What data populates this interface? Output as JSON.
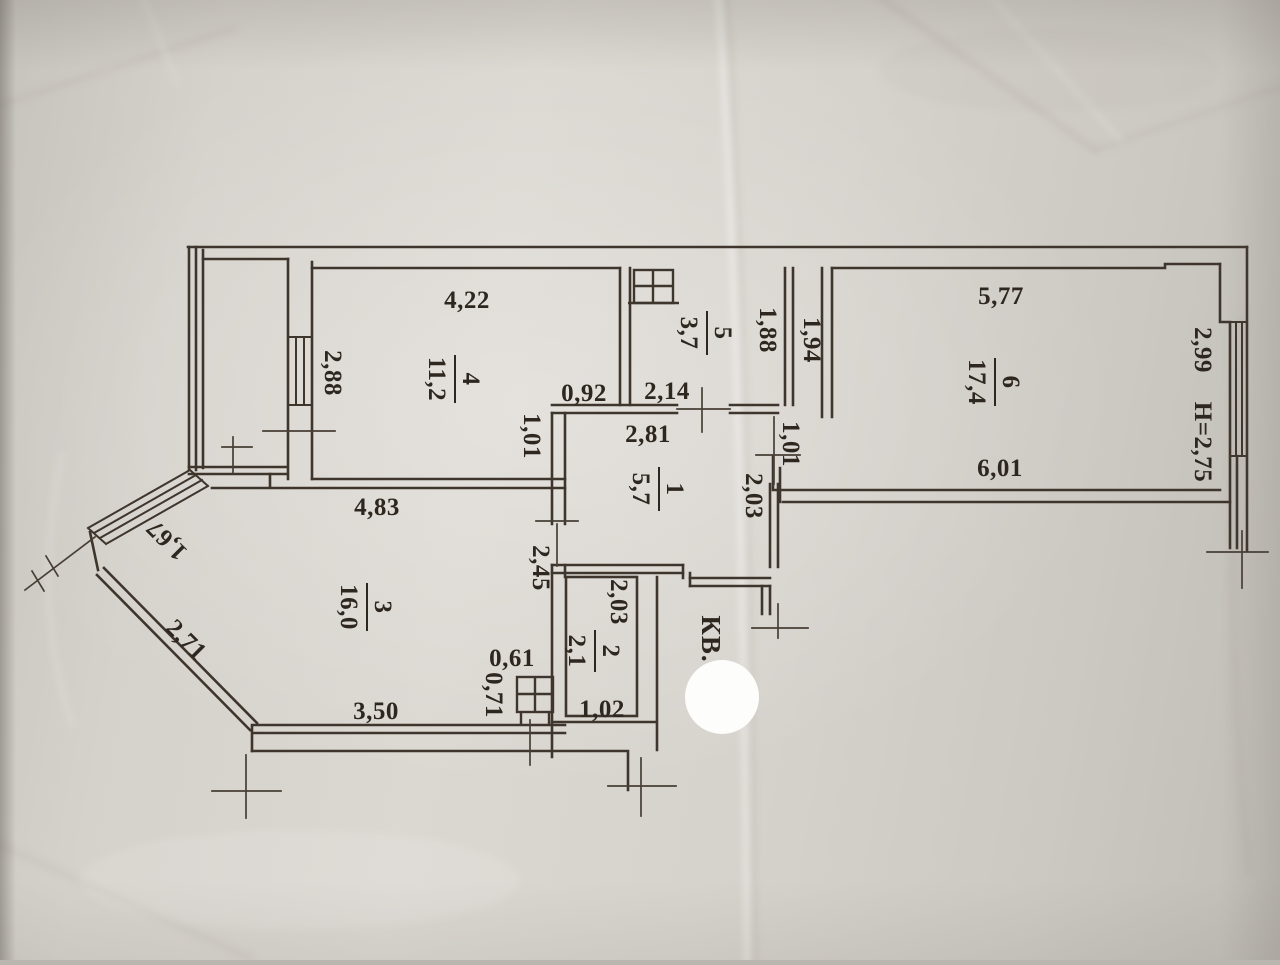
{
  "plan": {
    "apartment_prefix": "КВ.",
    "rooms": [
      {
        "number": "1",
        "area": "5,7"
      },
      {
        "number": "2",
        "area": "2,1"
      },
      {
        "number": "3",
        "area": "16,0"
      },
      {
        "number": "4",
        "area": "11,2"
      },
      {
        "number": "5",
        "area": "3,7"
      },
      {
        "number": "6",
        "area": "17,4"
      }
    ],
    "dims": {
      "r4_top": "4,22",
      "r4_left": "2,88",
      "r4_notch_w": "0,92",
      "r4_notch_h": "1,01",
      "r5_bottom": "2,14",
      "r5_right": "1,88",
      "shaft_wall": "1,94",
      "r6_top": "5,77",
      "r6_bottom": "6,01",
      "r6_right": "2,99",
      "ceiling_height": "H=2,75",
      "r1_top": "2,81",
      "r1_door": "1,01",
      "r1_right": "2,03",
      "r1_left": "2,45",
      "r3_top": "4,83",
      "r3_diag_window": "1,67",
      "r3_diag_wall": "2,71",
      "r3_bottom": "3,50",
      "r3_vent_w": "0,61",
      "r3_vent_h": "0,71",
      "r2_left": "2,03",
      "r2_bottom": "1,02"
    }
  }
}
